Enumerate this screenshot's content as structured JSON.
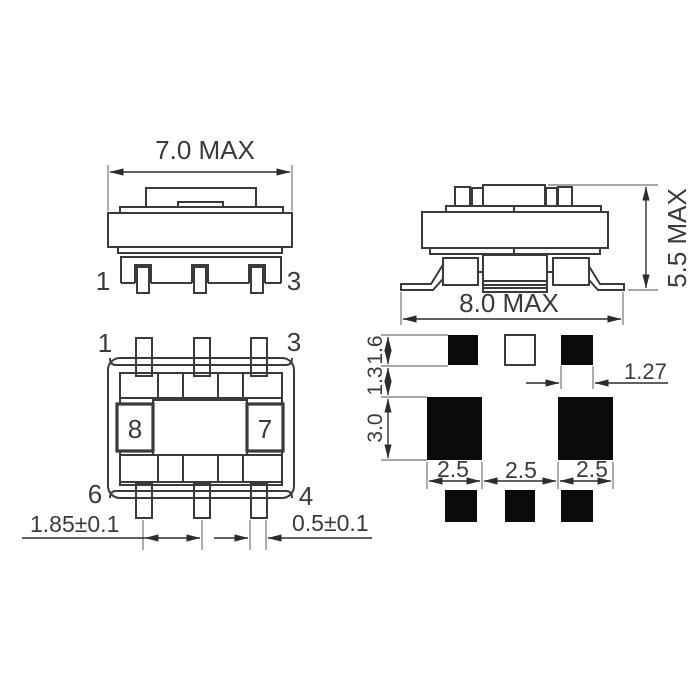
{
  "drawing": {
    "front_view": {
      "dim_width": "7.0 MAX",
      "pin_left": "1",
      "pin_right": "3"
    },
    "side_view": {
      "dim_width": "8.0 MAX",
      "dim_height": "5.5 MAX"
    },
    "bottom_view": {
      "pin_top_left": "1",
      "pin_top_right": "3",
      "pin_bottom_left": "6",
      "pin_bottom_right": "4",
      "marking_left": "8",
      "marking_right": "7",
      "dim_pin_pitch": "1.85±0.1",
      "dim_pin_width": "0.5±0.1"
    },
    "land_pattern": {
      "dim_top_pad_height": "1.6",
      "dim_row_gap": "1.3",
      "dim_main_pad_height": "3.0",
      "dim_pad_width_left": "2.5",
      "dim_pad_gap": "2.5",
      "dim_pad_width_right": "2.5",
      "dim_small_pad_width": "1.27"
    },
    "colors": {
      "line": "#3a3a3a",
      "dimension_line": "#2c2c2c",
      "extension_line": "#8a8a8a",
      "pad_fill": "#0b0b0b",
      "background": "#ffffff"
    }
  }
}
